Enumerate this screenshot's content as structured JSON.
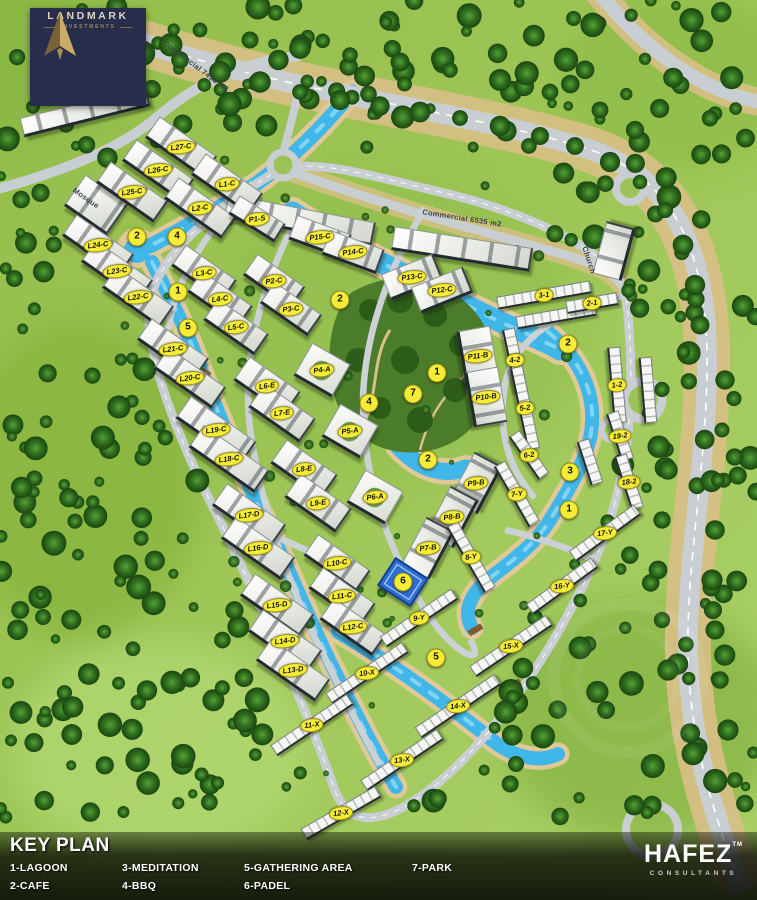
{
  "branding": {
    "landmark": {
      "name": "LANDMARK",
      "subtitle": "INVESTMENTS"
    },
    "consultant": {
      "name": "HAFEZ",
      "tm": "TM",
      "subtitle": "CONSULTANTS"
    }
  },
  "legend": {
    "title": "KEY PLAN",
    "columns": [
      [
        "1-LAGOON",
        "2-CAFE"
      ],
      [
        "3-MEDITATION",
        "4-BBQ"
      ],
      [
        "5-GATHERING AREA",
        "6-PADEL"
      ],
      [
        "7-PARK"
      ]
    ]
  },
  "map": {
    "area_labels": [
      {
        "text": "Commercial 7418 m2",
        "x": 196,
        "y": 66,
        "rot": 37
      },
      {
        "text": "Commercial 6535 m2",
        "x": 462,
        "y": 218,
        "rot": 9
      },
      {
        "text": "Mosque",
        "x": 86,
        "y": 198,
        "rot": 35
      },
      {
        "text": "Church",
        "x": 589,
        "y": 260,
        "rot": 72
      }
    ],
    "buildings": [
      {
        "label": "L27-C",
        "x": 181,
        "y": 147,
        "rot": 35,
        "w": 70,
        "h": 26,
        "kind": "slab"
      },
      {
        "label": "L26-C",
        "x": 158,
        "y": 170,
        "rot": 35,
        "w": 70,
        "h": 26,
        "kind": "slab"
      },
      {
        "label": "L25-C",
        "x": 132,
        "y": 192,
        "rot": 35,
        "w": 70,
        "h": 26,
        "kind": "slab"
      },
      {
        "label": "L1-C",
        "x": 227,
        "y": 184,
        "rot": 35,
        "w": 70,
        "h": 26,
        "kind": "slab"
      },
      {
        "label": "L2-C",
        "x": 200,
        "y": 208,
        "rot": 35,
        "w": 70,
        "h": 26,
        "kind": "slab"
      },
      {
        "label": "L24-C",
        "x": 98,
        "y": 245,
        "rot": 35,
        "w": 70,
        "h": 26,
        "kind": "slab"
      },
      {
        "label": "L23-C",
        "x": 117,
        "y": 271,
        "rot": 35,
        "w": 70,
        "h": 26,
        "kind": "slab"
      },
      {
        "label": "L22-C",
        "x": 138,
        "y": 297,
        "rot": 35,
        "w": 70,
        "h": 26,
        "kind": "slab"
      },
      {
        "label": "L3-C",
        "x": 204,
        "y": 273,
        "rot": 35,
        "w": 62,
        "h": 26,
        "kind": "slab"
      },
      {
        "label": "L4-C",
        "x": 220,
        "y": 299,
        "rot": 35,
        "w": 62,
        "h": 26,
        "kind": "slab"
      },
      {
        "label": "L5-C",
        "x": 236,
        "y": 327,
        "rot": 35,
        "w": 62,
        "h": 26,
        "kind": "slab"
      },
      {
        "label": "L21-C",
        "x": 173,
        "y": 349,
        "rot": 35,
        "w": 70,
        "h": 26,
        "kind": "slab"
      },
      {
        "label": "L20-C",
        "x": 190,
        "y": 378,
        "rot": 35,
        "w": 70,
        "h": 26,
        "kind": "slab"
      },
      {
        "label": "L19-C",
        "x": 216,
        "y": 430,
        "rot": 35,
        "w": 80,
        "h": 27,
        "kind": "slab"
      },
      {
        "label": "L18-C",
        "x": 229,
        "y": 459,
        "rot": 35,
        "w": 80,
        "h": 27,
        "kind": "slab"
      },
      {
        "label": "L17-D",
        "x": 249,
        "y": 515,
        "rot": 35,
        "w": 72,
        "h": 27,
        "kind": "slab"
      },
      {
        "label": "L16-D",
        "x": 258,
        "y": 548,
        "rot": 35,
        "w": 72,
        "h": 27,
        "kind": "slab"
      },
      {
        "label": "L15-D",
        "x": 277,
        "y": 605,
        "rot": 35,
        "w": 72,
        "h": 27,
        "kind": "slab"
      },
      {
        "label": "L14-D",
        "x": 285,
        "y": 641,
        "rot": 35,
        "w": 72,
        "h": 27,
        "kind": "slab"
      },
      {
        "label": "L13-D",
        "x": 293,
        "y": 670,
        "rot": 35,
        "w": 72,
        "h": 27,
        "kind": "slab"
      },
      {
        "label": "L6-E",
        "x": 267,
        "y": 386,
        "rot": 35,
        "w": 62,
        "h": 29,
        "kind": "slab"
      },
      {
        "label": "L7-E",
        "x": 282,
        "y": 413,
        "rot": 35,
        "w": 62,
        "h": 29,
        "kind": "slab"
      },
      {
        "label": "L8-E",
        "x": 304,
        "y": 469,
        "rot": 35,
        "w": 62,
        "h": 29,
        "kind": "slab"
      },
      {
        "label": "L9-E",
        "x": 318,
        "y": 503,
        "rot": 35,
        "w": 62,
        "h": 29,
        "kind": "slab"
      },
      {
        "label": "L10-C",
        "x": 337,
        "y": 563,
        "rot": 35,
        "w": 64,
        "h": 26,
        "kind": "slab"
      },
      {
        "label": "L11-C",
        "x": 342,
        "y": 596,
        "rot": 35,
        "w": 64,
        "h": 26,
        "kind": "slab"
      },
      {
        "label": "L12-C",
        "x": 353,
        "y": 627,
        "rot": 35,
        "w": 64,
        "h": 26,
        "kind": "slab"
      },
      {
        "label": "P1-S",
        "x": 257,
        "y": 219,
        "rot": 32,
        "w": 54,
        "h": 22,
        "kind": "slab"
      },
      {
        "label": "P15-C",
        "x": 320,
        "y": 237,
        "rot": 20,
        "w": 58,
        "h": 26,
        "kind": "slab"
      },
      {
        "label": "P14-C",
        "x": 353,
        "y": 252,
        "rot": 20,
        "w": 58,
        "h": 26,
        "kind": "slab"
      },
      {
        "label": "P2-C",
        "x": 274,
        "y": 281,
        "rot": 35,
        "w": 58,
        "h": 26,
        "kind": "slab"
      },
      {
        "label": "P3-C",
        "x": 291,
        "y": 309,
        "rot": 35,
        "w": 58,
        "h": 26,
        "kind": "slab"
      },
      {
        "label": "P13-C",
        "x": 412,
        "y": 277,
        "rot": -22,
        "w": 56,
        "h": 28,
        "kind": "slab"
      },
      {
        "label": "P12-C",
        "x": 442,
        "y": 290,
        "rot": -22,
        "w": 56,
        "h": 28,
        "kind": "slab"
      },
      {
        "label": "P11-B",
        "x": 478,
        "y": 356,
        "rot": 80,
        "w": 56,
        "h": 34,
        "kind": "slab"
      },
      {
        "label": "P10-B",
        "x": 486,
        "y": 397,
        "rot": 80,
        "w": 56,
        "h": 34,
        "kind": "slab"
      },
      {
        "label": "P9-B",
        "x": 476,
        "y": 483,
        "rot": -62,
        "w": 54,
        "h": 32,
        "kind": "slab"
      },
      {
        "label": "P8-B",
        "x": 452,
        "y": 517,
        "rot": -62,
        "w": 54,
        "h": 32,
        "kind": "slab"
      },
      {
        "label": "P7-B",
        "x": 428,
        "y": 548,
        "rot": -62,
        "w": 54,
        "h": 32,
        "kind": "slab"
      },
      {
        "label": "P4-A",
        "x": 322,
        "y": 370,
        "rot": 30,
        "w": 44,
        "h": 38,
        "kind": "square"
      },
      {
        "label": "P5-A",
        "x": 350,
        "y": 431,
        "rot": 30,
        "w": 44,
        "h": 38,
        "kind": "square"
      },
      {
        "label": "P6-A",
        "x": 375,
        "y": 497,
        "rot": 30,
        "w": 44,
        "h": 38,
        "kind": "square"
      },
      {
        "label": "3-1",
        "x": 544,
        "y": 295,
        "rot": -10,
        "w": 95,
        "h": 13,
        "kind": "strip"
      },
      {
        "label": "2-1",
        "x": 592,
        "y": 303,
        "rot": -10,
        "w": 52,
        "h": 13,
        "kind": "strip"
      },
      {
        "label": "4-2",
        "x": 515,
        "y": 360,
        "rot": 78,
        "w": 64,
        "h": 13,
        "kind": "strip"
      },
      {
        "label": "5-2",
        "x": 525,
        "y": 408,
        "rot": 78,
        "w": 84,
        "h": 13,
        "kind": "strip"
      },
      {
        "label": "1-2",
        "x": 617,
        "y": 385,
        "rot": 85,
        "w": 76,
        "h": 13,
        "kind": "strip"
      },
      {
        "label": "19-2",
        "x": 620,
        "y": 436,
        "rot": 72,
        "w": 50,
        "h": 13,
        "kind": "strip"
      },
      {
        "label": "18-2",
        "x": 629,
        "y": 482,
        "rot": 72,
        "w": 56,
        "h": 13,
        "kind": "strip"
      },
      {
        "label": "6-2",
        "x": 529,
        "y": 455,
        "rot": 55,
        "w": 52,
        "h": 13,
        "kind": "strip"
      },
      {
        "label": "7-Y",
        "x": 517,
        "y": 494,
        "rot": 60,
        "w": 70,
        "h": 13,
        "kind": "strip"
      },
      {
        "label": "8-Y",
        "x": 471,
        "y": 557,
        "rot": 60,
        "w": 76,
        "h": 13,
        "kind": "strip"
      },
      {
        "label": "17-Y",
        "x": 605,
        "y": 533,
        "rot": -36,
        "w": 80,
        "h": 13,
        "kind": "strip"
      },
      {
        "label": "16-Y",
        "x": 562,
        "y": 586,
        "rot": -36,
        "w": 80,
        "h": 13,
        "kind": "strip"
      },
      {
        "label": "9-Y",
        "x": 419,
        "y": 618,
        "rot": -34,
        "w": 86,
        "h": 13,
        "kind": "strip"
      },
      {
        "label": "15-X",
        "x": 511,
        "y": 646,
        "rot": -34,
        "w": 92,
        "h": 13,
        "kind": "strip"
      },
      {
        "label": "10-X",
        "x": 367,
        "y": 673,
        "rot": -34,
        "w": 92,
        "h": 13,
        "kind": "strip"
      },
      {
        "label": "14-X",
        "x": 458,
        "y": 706,
        "rot": -34,
        "w": 96,
        "h": 13,
        "kind": "strip"
      },
      {
        "label": "11-X",
        "x": 312,
        "y": 725,
        "rot": -34,
        "w": 92,
        "h": 13,
        "kind": "strip"
      },
      {
        "label": "13-X",
        "x": 402,
        "y": 760,
        "rot": -34,
        "w": 92,
        "h": 13,
        "kind": "strip"
      },
      {
        "label": "12-X",
        "x": 341,
        "y": 813,
        "rot": -30,
        "w": 86,
        "h": 13,
        "kind": "strip"
      }
    ],
    "amenities": [
      {
        "n": "2",
        "x": 137,
        "y": 237
      },
      {
        "n": "4",
        "x": 177,
        "y": 237
      },
      {
        "n": "1",
        "x": 178,
        "y": 292
      },
      {
        "n": "5",
        "x": 188,
        "y": 328
      },
      {
        "n": "2",
        "x": 340,
        "y": 300
      },
      {
        "n": "1",
        "x": 437,
        "y": 373
      },
      {
        "n": "7",
        "x": 413,
        "y": 394
      },
      {
        "n": "4",
        "x": 369,
        "y": 403
      },
      {
        "n": "2",
        "x": 428,
        "y": 460
      },
      {
        "n": "6",
        "x": 403,
        "y": 582
      },
      {
        "n": "2",
        "x": 568,
        "y": 344
      },
      {
        "n": "3",
        "x": 570,
        "y": 472
      },
      {
        "n": "1",
        "x": 569,
        "y": 510
      },
      {
        "n": "5",
        "x": 436,
        "y": 658
      }
    ]
  }
}
